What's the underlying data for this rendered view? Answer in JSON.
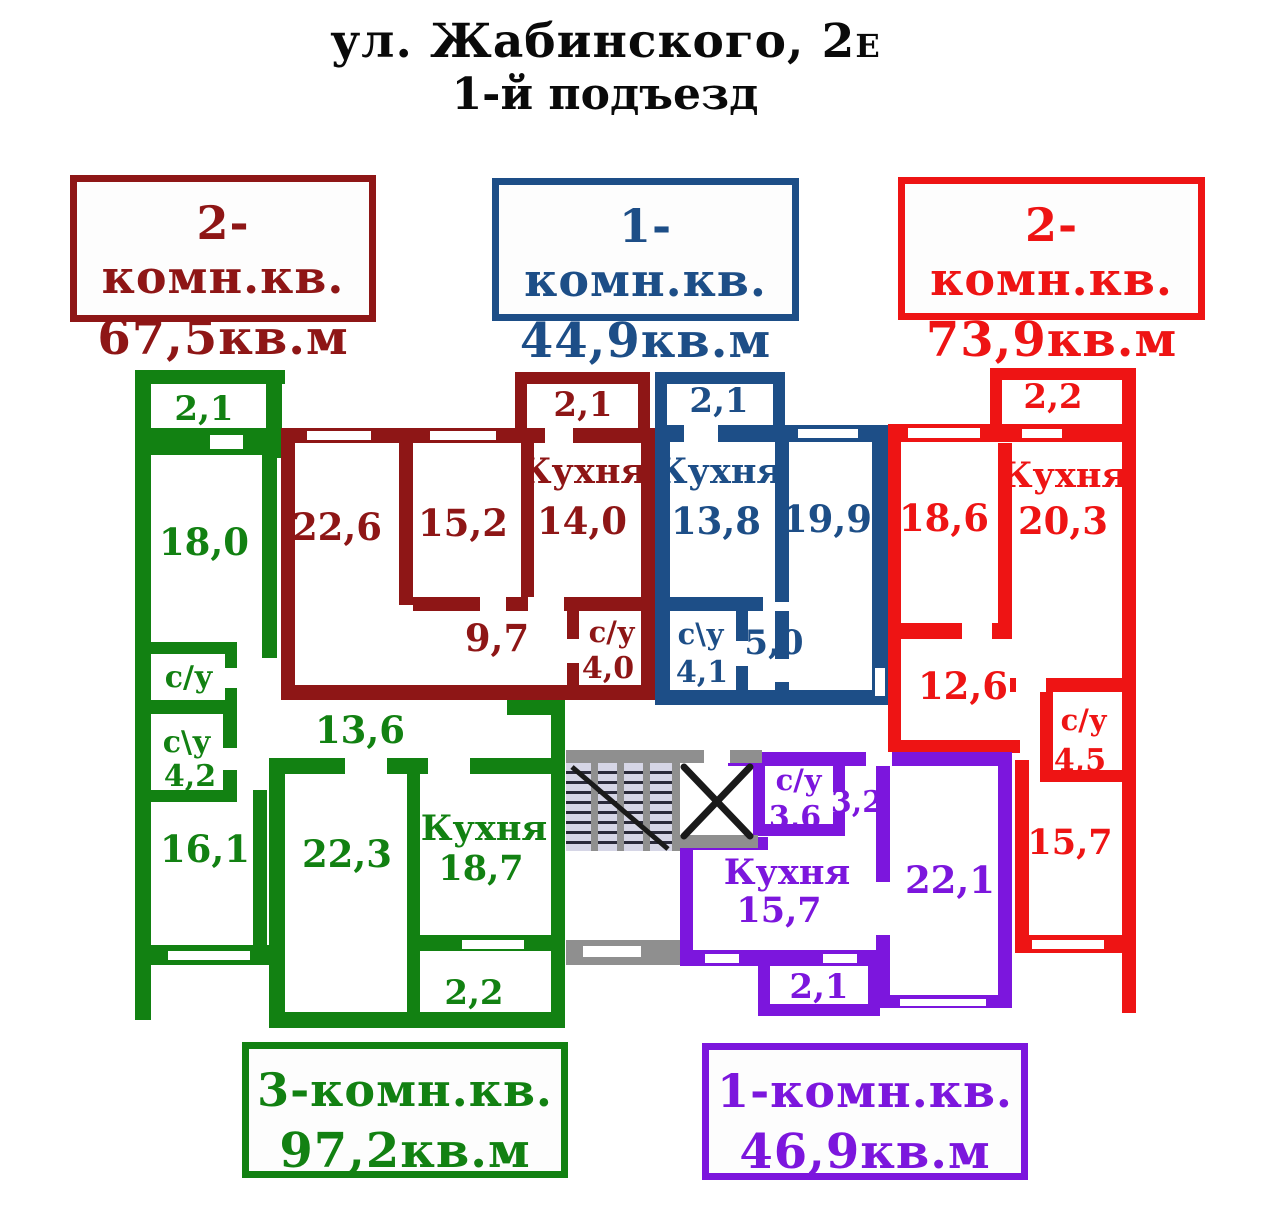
{
  "title": {
    "line1_main": "ул. Жабинского, 2",
    "line1_suffix": "Е",
    "line2": "1-й подъезд"
  },
  "colors": {
    "green": "#128112",
    "dark_red": "#8e1616",
    "blue": "#1d4e87",
    "red": "#ee1414",
    "purple": "#7c16dd",
    "gray": "#8f8f8f",
    "stair_fill": "#d6d6e6",
    "line_dark": "#1a1a1a"
  },
  "legend": {
    "darkred": {
      "type": "2-комн.кв.",
      "area": "67,5кв.м"
    },
    "blue": {
      "type": "1-комн.кв.",
      "area": "44,9кв.м"
    },
    "red": {
      "type": "2-комн.кв.",
      "area": "73,9кв.м"
    },
    "green": {
      "type": "3-комн.кв.",
      "area": "97,2кв.м"
    },
    "purple": {
      "type": "1-комн.кв.",
      "area": "46,9кв.м"
    }
  },
  "plan": {
    "green": {
      "balcony_top": "2,1",
      "room_180": "18,0",
      "wc_small": "с/у",
      "wc2": "с\\у",
      "wc2_area": "4,2",
      "room_161": "16,1",
      "hall_136": "13,6",
      "room_223": "22,3",
      "kitchen": "Кухня",
      "kitchen_area": "18,7",
      "balcony_bottom": "2,2"
    },
    "darkred": {
      "balcony": "2,1",
      "room_226": "22,6",
      "room_152": "15,2",
      "kitchen": "Кухня",
      "kitchen_area": "14,0",
      "hall_97": "9,7",
      "wc": "с/у",
      "wc_area": "4,0"
    },
    "blue": {
      "balcony": "2,1",
      "kitchen": "Кухня",
      "kitchen_area": "13,8",
      "room_199": "19,9",
      "wc": "с\\у",
      "wc_area": "4,1",
      "hall_50": "5,0"
    },
    "red": {
      "balcony": "2,2",
      "room_186": "18,6",
      "kitchen": "Кухня",
      "kitchen_area": "20,3",
      "hall_126": "12,6",
      "wc": "с/у",
      "wc_area": "4,5",
      "room_157": "15,7"
    },
    "purple": {
      "wc": "с/у",
      "wc_area": "3,6",
      "hall_32": "3,2",
      "kitchen": "Кухня",
      "kitchen_area": "15,7",
      "room_221": "22,1",
      "balcony": "2,1"
    }
  }
}
